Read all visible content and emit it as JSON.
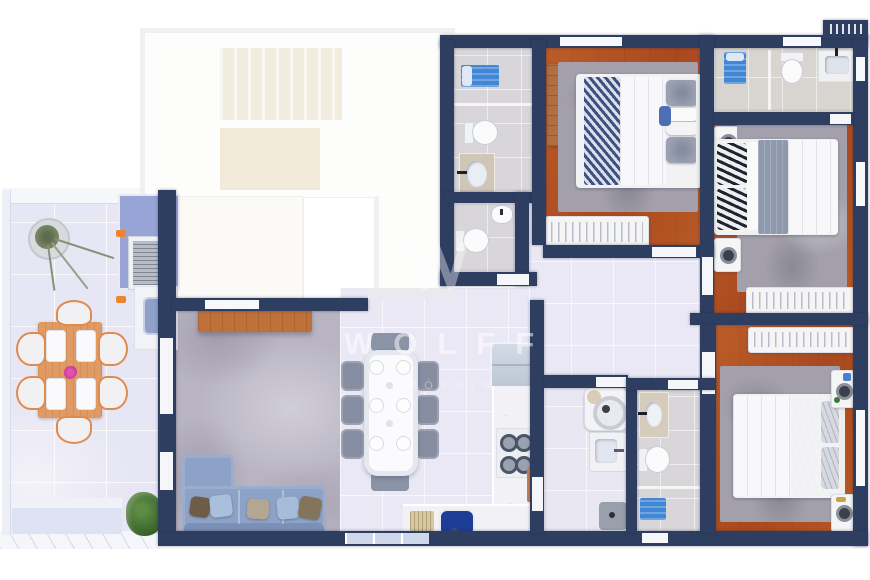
{
  "watermark": {
    "brand": "WOLFF",
    "subtitle": "IMÓVEIS",
    "logo": "w-monogram"
  },
  "palette": {
    "wall_navy": "#2e3e61",
    "wood_floor_orange": "#d4905e",
    "interior_tile": "#e9e8f4",
    "bathroom_tile": "#d9d6da",
    "terrace_tile": "#e7e6f4",
    "living_concrete": "#b8b4c3",
    "rug_gray": "#a3a0ac",
    "sofa_blue_gray": "#8da2c6",
    "shower_mat_blue": "#4287d6",
    "kitchen_sink_blue": "#1e3d96",
    "grill_counter_periwinkle": "#98a3d6",
    "patio_wood": "#e09a63",
    "flower_pink": "#d6389b",
    "plant_green": "#4e7a3a"
  },
  "rooms": [
    {
      "name": "terrace"
    },
    {
      "name": "unfinished-area"
    },
    {
      "name": "living-room"
    },
    {
      "name": "dining-area"
    },
    {
      "name": "kitchen"
    },
    {
      "name": "hallway"
    },
    {
      "name": "bathroom-top"
    },
    {
      "name": "bathroom-hall"
    },
    {
      "name": "bedroom-1"
    },
    {
      "name": "bathroom-right"
    },
    {
      "name": "bedroom-2"
    },
    {
      "name": "laundry"
    },
    {
      "name": "ensuite-bathroom"
    },
    {
      "name": "master-bedroom"
    }
  ],
  "furniture": {
    "terrace": [
      "potted-plant",
      "barbecue-grill-counter",
      "outdoor-sink-counter",
      "patio-dining-table",
      "patio-chairs-6",
      "flower-centerpiece",
      "bench-planter",
      "shrub-plant"
    ],
    "living_room": [
      "wooden-console",
      "l-shaped-sofa",
      "throw-pillows-5"
    ],
    "dining_area": [
      "dining-table",
      "dining-chairs-6",
      "benches-2",
      "place-settings-6"
    ],
    "kitchen": [
      "refrigerator",
      "cooktop-4-burners",
      "l-counter",
      "blue-sink",
      "dish-rack",
      "cutting-board"
    ],
    "laundry": [
      "washing-machine",
      "laundry-sink",
      "waste-bin"
    ],
    "bathrooms": [
      "shower-with-blue-mat-x3",
      "toilet-x4",
      "bidet",
      "vanity-sink-x3"
    ],
    "bedroom_1": [
      "double-bed",
      "striped-runner-blanket",
      "gray-pillows",
      "wood-dresser",
      "open-wardrobe-rail",
      "area-rug"
    ],
    "bedroom_2": [
      "double-bed",
      "zebra-pillows",
      "gray-blanket",
      "nightstands-2-with-lamps",
      "open-wardrobe-rail",
      "area-rug"
    ],
    "master_bedroom": [
      "double-bed",
      "draped-gray-blanket",
      "crinkle-pillows",
      "nightstands-2-with-lamps",
      "open-wardrobe-rail",
      "area-rug"
    ],
    "exterior": [
      "ac-condenser-ledge"
    ]
  }
}
